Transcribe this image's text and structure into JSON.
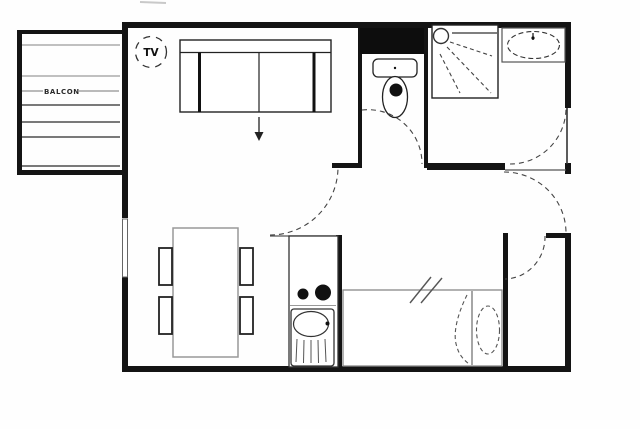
{
  "plan": {
    "labels": {
      "balcony": "BALCON",
      "tv": "TV"
    },
    "colors": {
      "background": "#fefefe",
      "wall": "#141414",
      "line_dark": "#333333",
      "line_gray": "#8f8f8f",
      "fixture_fill": "#111111"
    },
    "elements": [
      "balcony",
      "tv",
      "sofa",
      "sofa-arrow",
      "wc-duct",
      "toilet",
      "shower",
      "washbasin",
      "dining-table",
      "dining-chairs",
      "kitchen-hob",
      "kitchen-sink",
      "bed",
      "pillow",
      "window",
      "wc-door",
      "bathroom-door",
      "hall-door",
      "entry-door",
      "closet-door"
    ]
  }
}
